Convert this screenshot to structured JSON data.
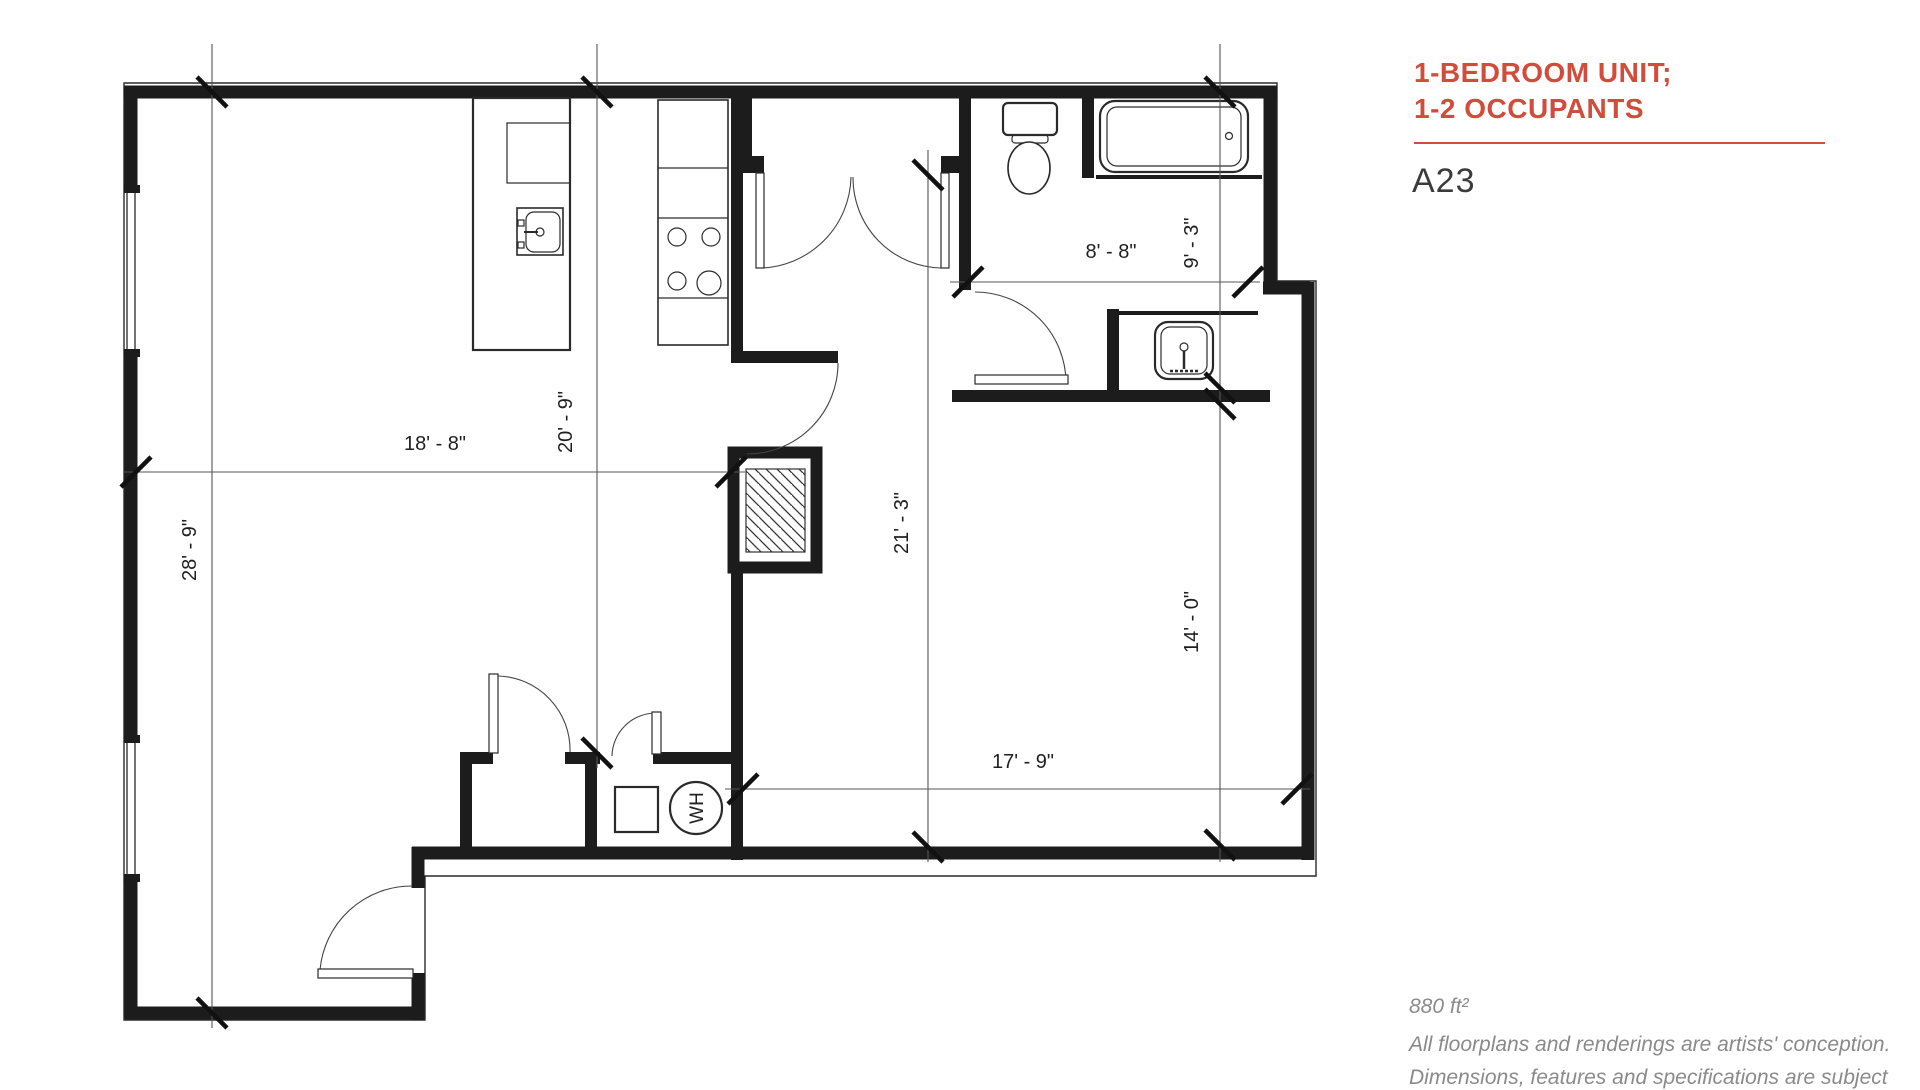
{
  "panel": {
    "title_line1": "1-BEDROOM UNIT;",
    "title_line2": "1-2 OCCUPANTS",
    "accent_color": "#d24c3b",
    "unit_code": "A23",
    "area_label": "880 ft²",
    "disclaimer_line1": "All floorplans and renderings are artists' conception.",
    "disclaimer_line2": "Dimensions, features and specifications are subject"
  },
  "plan": {
    "dims": {
      "living_width": "18' - 8\"",
      "kitchen_depth": "20' - 9\"",
      "living_depth": "28' - 9\"",
      "bedroom_full_depth": "21' - 3\"",
      "bath_width": "8' - 8\"",
      "bath_depth": "9' - 3\"",
      "bedroom_depth": "14' - 0\"",
      "bedroom_width": "17' - 9\""
    },
    "labels": {
      "water_heater": "WH"
    }
  }
}
